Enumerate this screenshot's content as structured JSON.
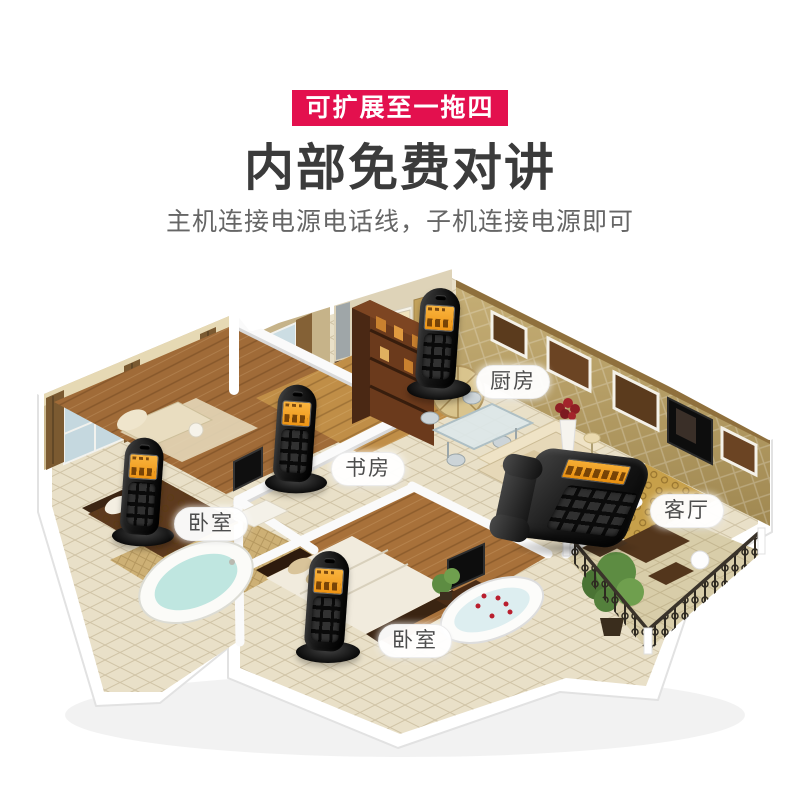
{
  "banner": {
    "text": "可扩展至一拖四",
    "bg_color": "#e3104e",
    "text_color": "#ffffff"
  },
  "headline": {
    "text": "内部免费对讲",
    "color": "#3b3b3b"
  },
  "subtitle": {
    "text": "主机连接电源电话线，子机连接电源即可",
    "color": "#666666"
  },
  "scene": {
    "room_labels": [
      {
        "id": "kitchen",
        "text": "厨房"
      },
      {
        "id": "study",
        "text": "书房"
      },
      {
        "id": "bedroom-left",
        "text": "卧室"
      },
      {
        "id": "living-room",
        "text": "客厅"
      },
      {
        "id": "bedroom-bottom",
        "text": "卧室"
      }
    ],
    "phones": [
      {
        "id": "handset-kitchen",
        "type": "cordless-handset",
        "room": "厨房"
      },
      {
        "id": "handset-study",
        "type": "cordless-handset",
        "room": "书房"
      },
      {
        "id": "handset-bedroom-left",
        "type": "cordless-handset",
        "room": "卧室"
      },
      {
        "id": "handset-bedroom-bottom",
        "type": "cordless-handset",
        "room": "卧室"
      },
      {
        "id": "desk-phone-living-room",
        "type": "corded-desk-phone",
        "room": "客厅"
      }
    ],
    "phone_colors": {
      "body": "#141414",
      "screen": "#f2a52a"
    }
  }
}
